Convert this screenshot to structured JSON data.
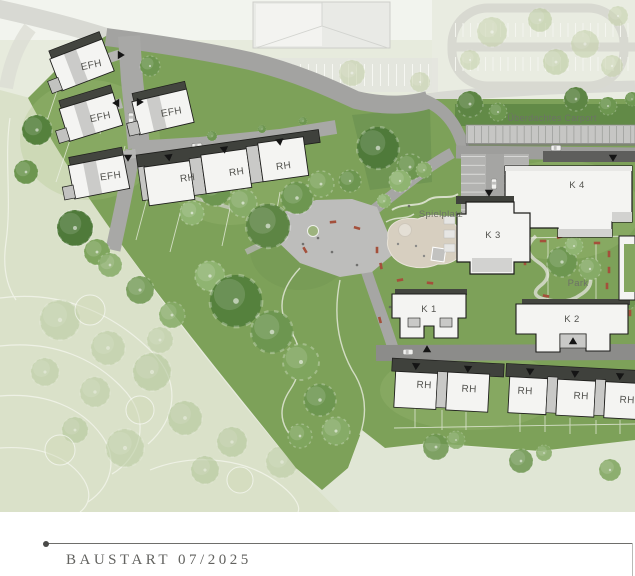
{
  "plan": {
    "labels": {
      "efh": "EFH",
      "rh": "RH",
      "k1": "K 1",
      "k2": "K 2",
      "k3": "K 3",
      "k4": "K 4",
      "carport": "Überdachtes Carport",
      "spielplatz": "Spielplatz",
      "park": "Park"
    },
    "colors": {
      "site_green": "#7da159",
      "faded_green": "#dae1c9",
      "road_gray": "#a3a3a1",
      "building_white": "#f4f4f2",
      "roof_dark": "#3f413c",
      "sand": "#d7cfc0",
      "bench_red": "#a4503b"
    }
  },
  "footer": {
    "milestone": "BAUSTART 07/2025"
  }
}
